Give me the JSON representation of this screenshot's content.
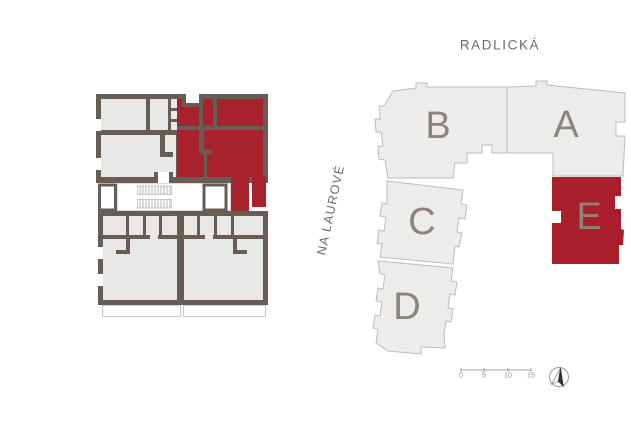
{
  "page": {
    "background": "#ffffff"
  },
  "floor_plan": {
    "description": "apartment floor plan with highlighted unit",
    "wall_color": "#675d54",
    "room_color": "#e8e8e7",
    "highlight_color": "#a8222e"
  },
  "site_plan": {
    "street_top": "RADLICKÁ",
    "street_left": "NA LAUROVÉ",
    "building_fill": "#ececea",
    "building_outline": "#bdbdbb",
    "highlight_fill": "#a81e2c",
    "label_color": "#8d8379",
    "buildings": [
      {
        "id": "B",
        "label": "B",
        "highlighted": false
      },
      {
        "id": "A",
        "label": "A",
        "highlighted": false
      },
      {
        "id": "C",
        "label": "C",
        "highlighted": false
      },
      {
        "id": "D",
        "label": "D",
        "highlighted": false
      },
      {
        "id": "E",
        "label": "E",
        "highlighted": true
      }
    ],
    "scale_bar": {
      "tick_labels": [
        "0",
        "5",
        "10",
        "15"
      ]
    },
    "compass": "north-arrow"
  }
}
